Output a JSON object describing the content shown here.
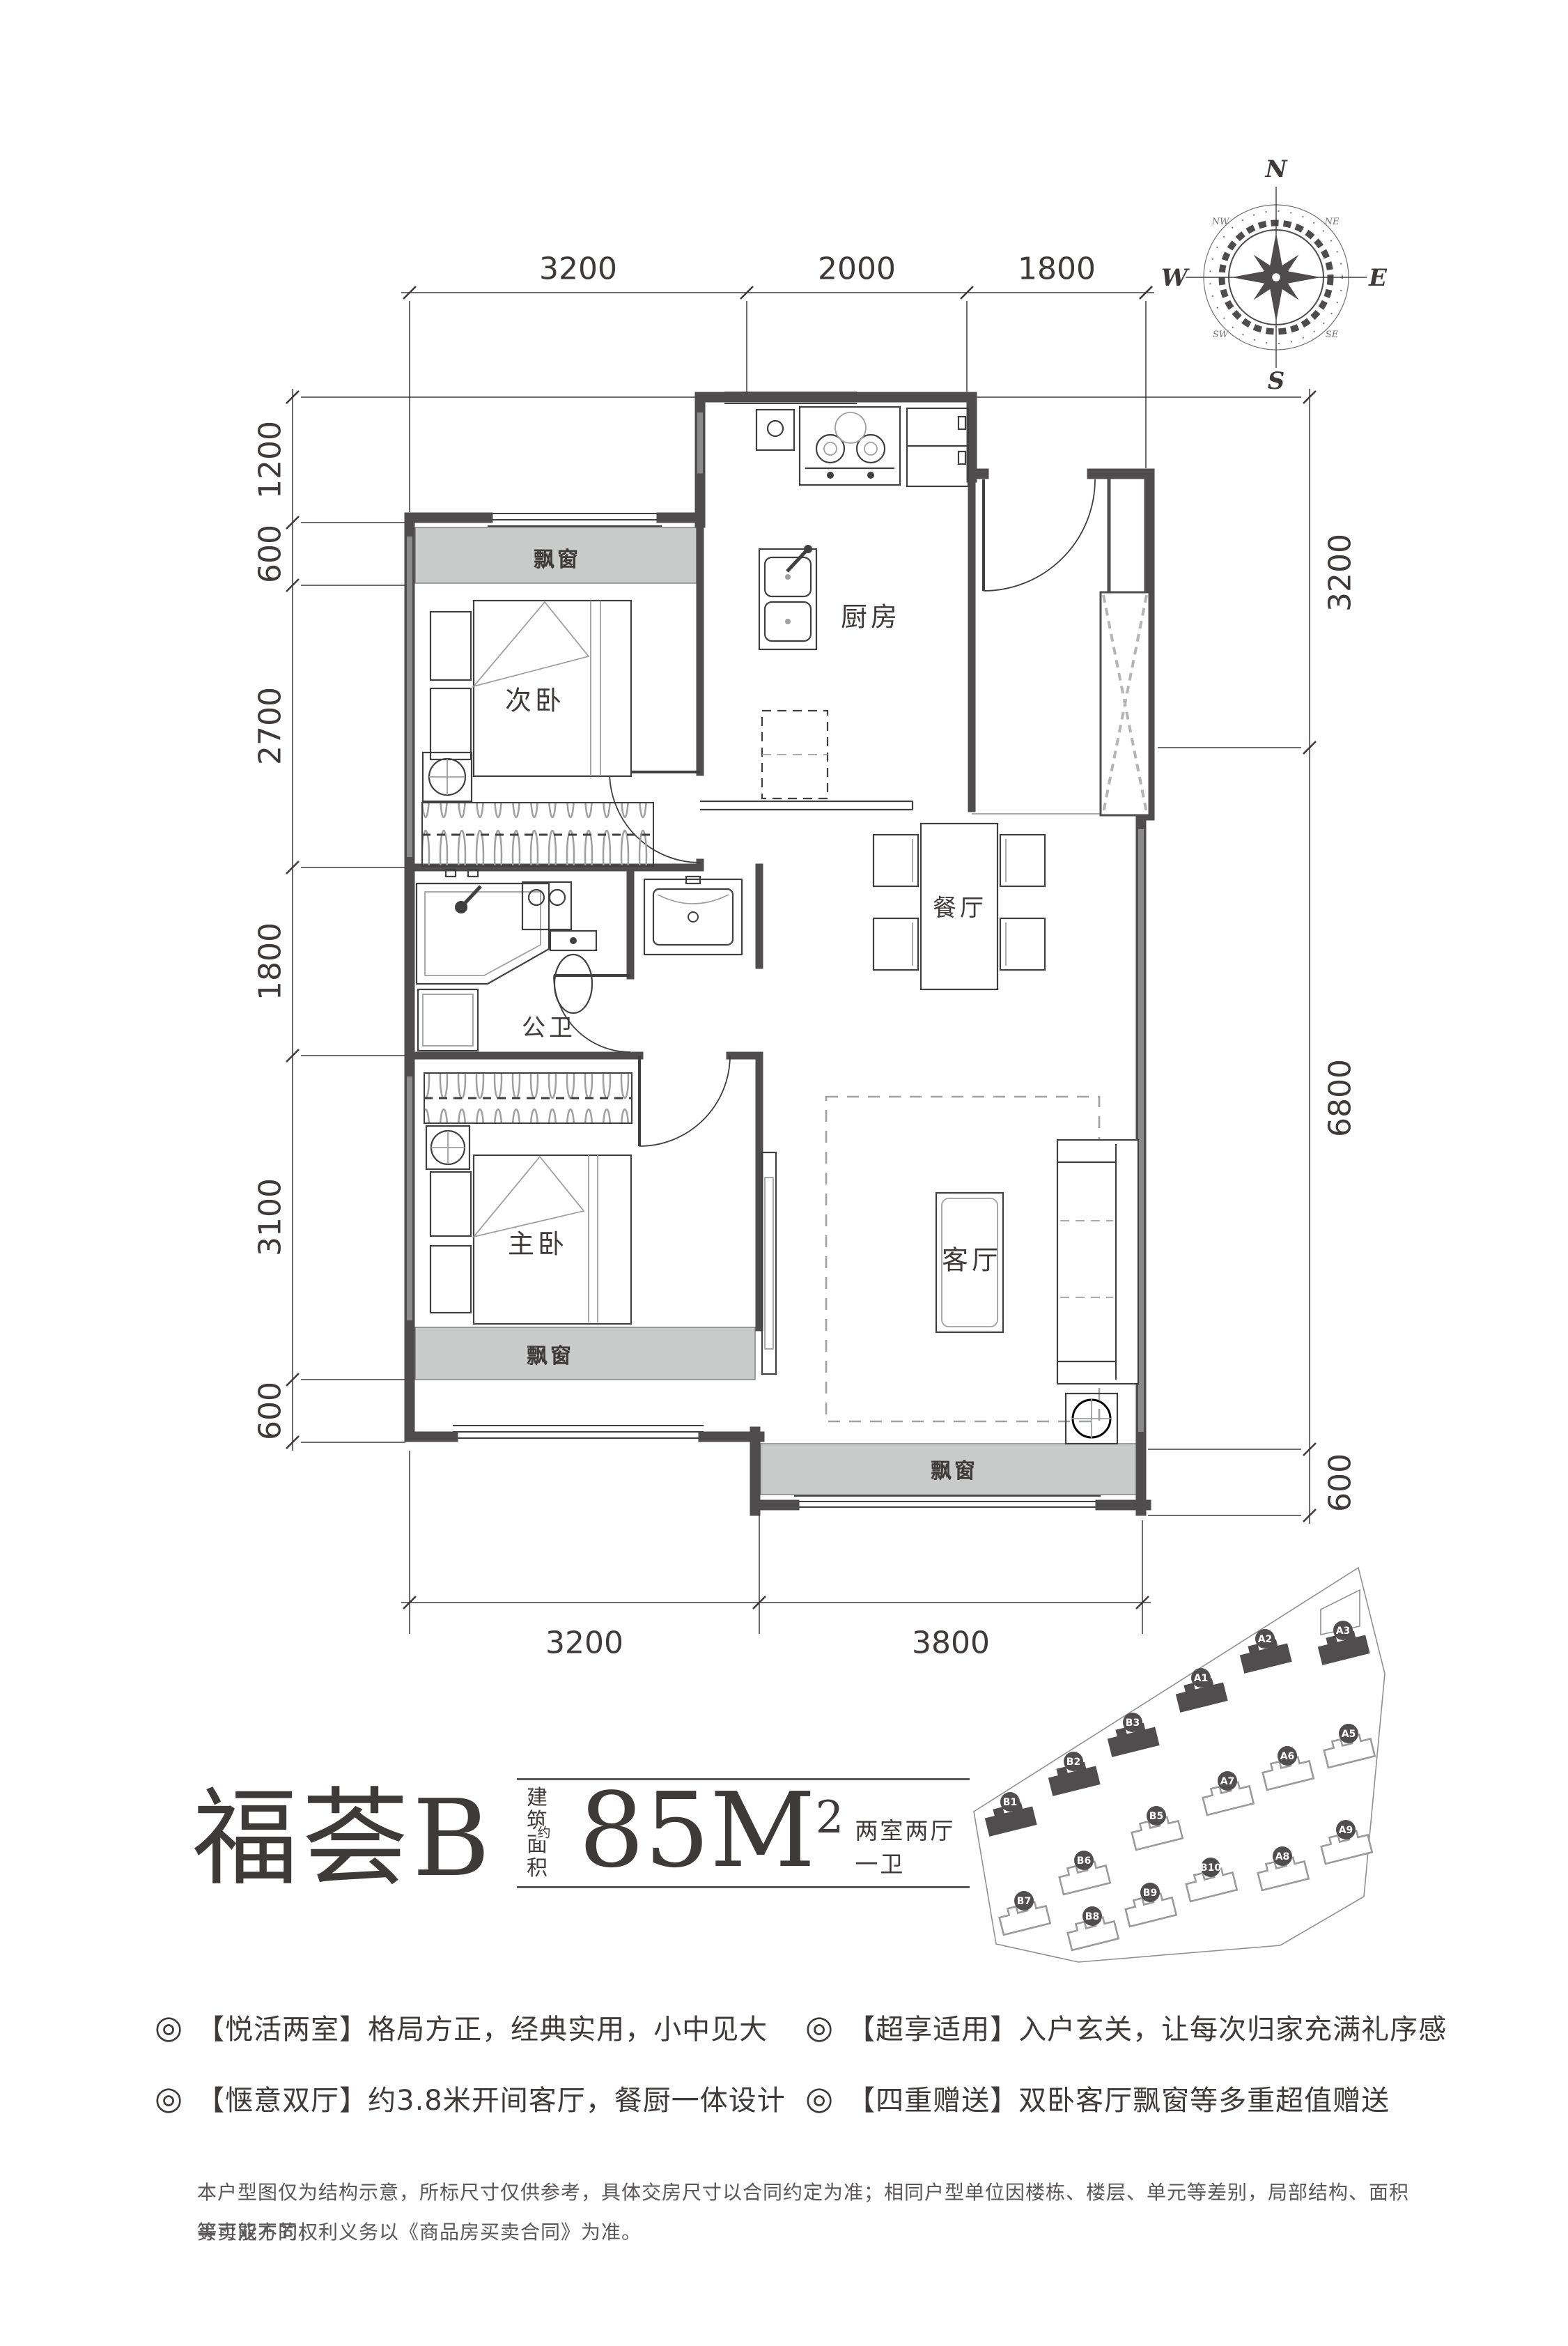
{
  "title": {
    "name": "福荟B",
    "area_label_l1": "建筑",
    "area_label_l2": "面积",
    "area_approx": "约",
    "area_value": "85M",
    "area_sup": "2",
    "spec": "两室两厅一卫"
  },
  "plan": {
    "rooms": {
      "bedroom2": "次卧",
      "kitchen": "厨房",
      "dining": "餐厅",
      "bathroom": "公卫",
      "master": "主卧",
      "living": "客厅"
    },
    "bays": {
      "bedroom2": "飘窗",
      "master": "飘窗",
      "living": "飘窗"
    },
    "dims": {
      "top": [
        "3200",
        "2000",
        "1800"
      ],
      "left": [
        "1200",
        "600",
        "2700",
        "1800",
        "3100",
        "600"
      ],
      "right": [
        "3200",
        "6800",
        "600"
      ],
      "bottom": [
        "3200",
        "3800"
      ]
    }
  },
  "compass": {
    "n": "N",
    "e": "E",
    "s": "S",
    "w": "W",
    "nw": "NW",
    "ne": "NE",
    "sw": "SW",
    "se": "SE"
  },
  "features": [
    {
      "bullet": "◎",
      "text": "【悦活两室】格局方正，经典实用，小中见大"
    },
    {
      "bullet": "◎",
      "text": "【惬意双厅】约3.8米开间客厅，餐厨一体设计"
    },
    {
      "bullet": "◎",
      "text": "【超享适用】入户玄关，让每次归家充满礼序感"
    },
    {
      "bullet": "◎",
      "text": "【四重赠送】双卧客厅飘窗等多重超值赠送"
    }
  ],
  "disclaimer": {
    "line1": "本户型图仅为结构示意，所标尺寸仅供参考，具体交房尺寸以合同约定为准；相同户型单位因楼栋、楼层、单元等差别，局部结构、面积等可能不同，",
    "line2": "买卖双方的权利义务以《商品房买卖合同》为准。"
  },
  "siteplan": {
    "buildings": [
      {
        "id": "A1",
        "filled": true
      },
      {
        "id": "A2",
        "filled": true
      },
      {
        "id": "A3",
        "filled": true
      },
      {
        "id": "B1",
        "filled": true
      },
      {
        "id": "B2",
        "filled": true
      },
      {
        "id": "B3",
        "filled": true
      },
      {
        "id": "A5",
        "filled": false
      },
      {
        "id": "A6",
        "filled": false
      },
      {
        "id": "A7",
        "filled": false
      },
      {
        "id": "A8",
        "filled": false
      },
      {
        "id": "A9",
        "filled": false
      },
      {
        "id": "B5",
        "filled": false
      },
      {
        "id": "B6",
        "filled": false
      },
      {
        "id": "B7",
        "filled": false
      },
      {
        "id": "B8",
        "filled": false
      },
      {
        "id": "B9",
        "filled": false
      },
      {
        "id": "B10",
        "filled": false
      }
    ]
  }
}
